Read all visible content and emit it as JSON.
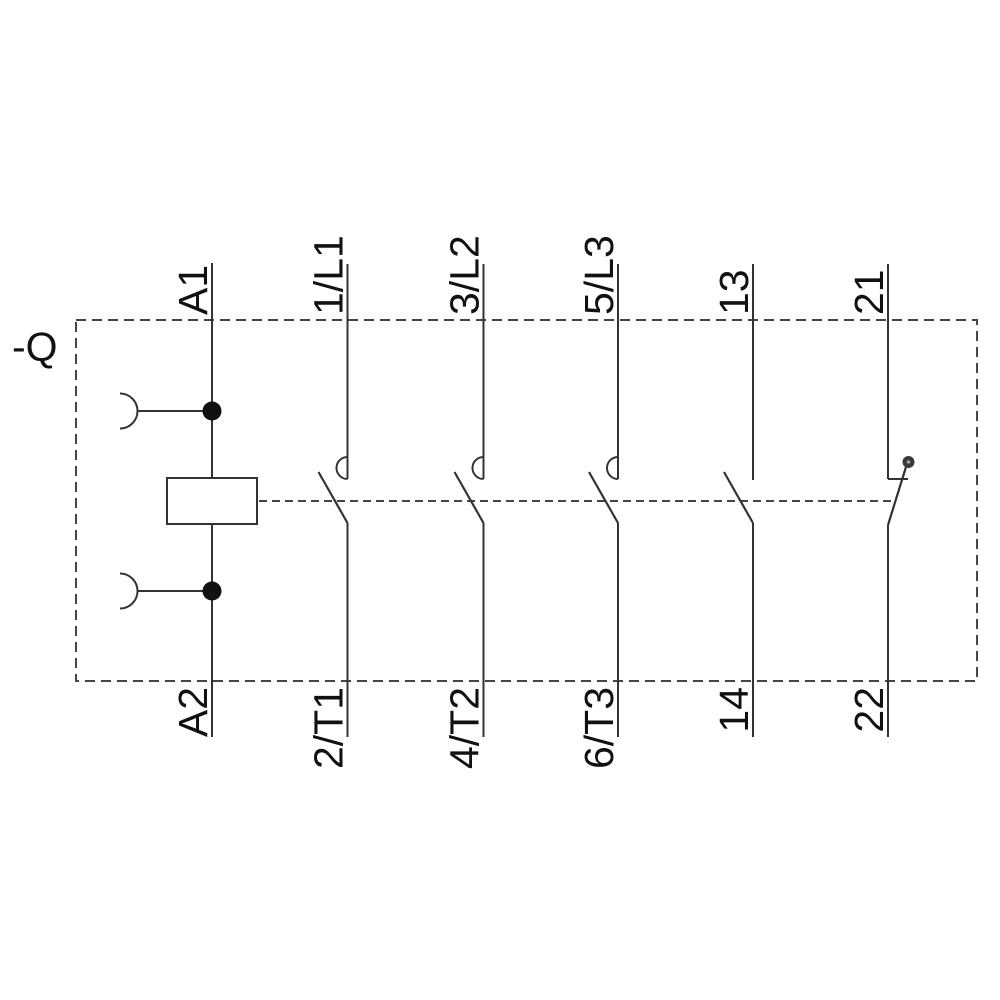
{
  "header": {
    "device_tag": "-Q"
  },
  "columns": [
    {
      "id": "coil",
      "kind": "coil",
      "top_terminal": "A1",
      "bottom_terminal": "A2"
    },
    {
      "id": "pole-1",
      "kind": "main-no-contact",
      "top_terminal": "1/L1",
      "bottom_terminal": "2/T1"
    },
    {
      "id": "pole-2",
      "kind": "main-no-contact",
      "top_terminal": "3/L2",
      "bottom_terminal": "4/T2"
    },
    {
      "id": "pole-3",
      "kind": "main-no-contact",
      "top_terminal": "5/L3",
      "bottom_terminal": "6/T3"
    },
    {
      "id": "aux-no",
      "kind": "auxiliary-no-contact",
      "top_terminal": "13",
      "bottom_terminal": "14"
    },
    {
      "id": "aux-nc",
      "kind": "auxiliary-nc-contact",
      "top_terminal": "21",
      "bottom_terminal": "22"
    }
  ],
  "colors": {
    "wire": "#333333",
    "dashed": "#444444",
    "text": "#111111",
    "background": "#ffffff",
    "pivot_dot": "#3a3a3a"
  }
}
